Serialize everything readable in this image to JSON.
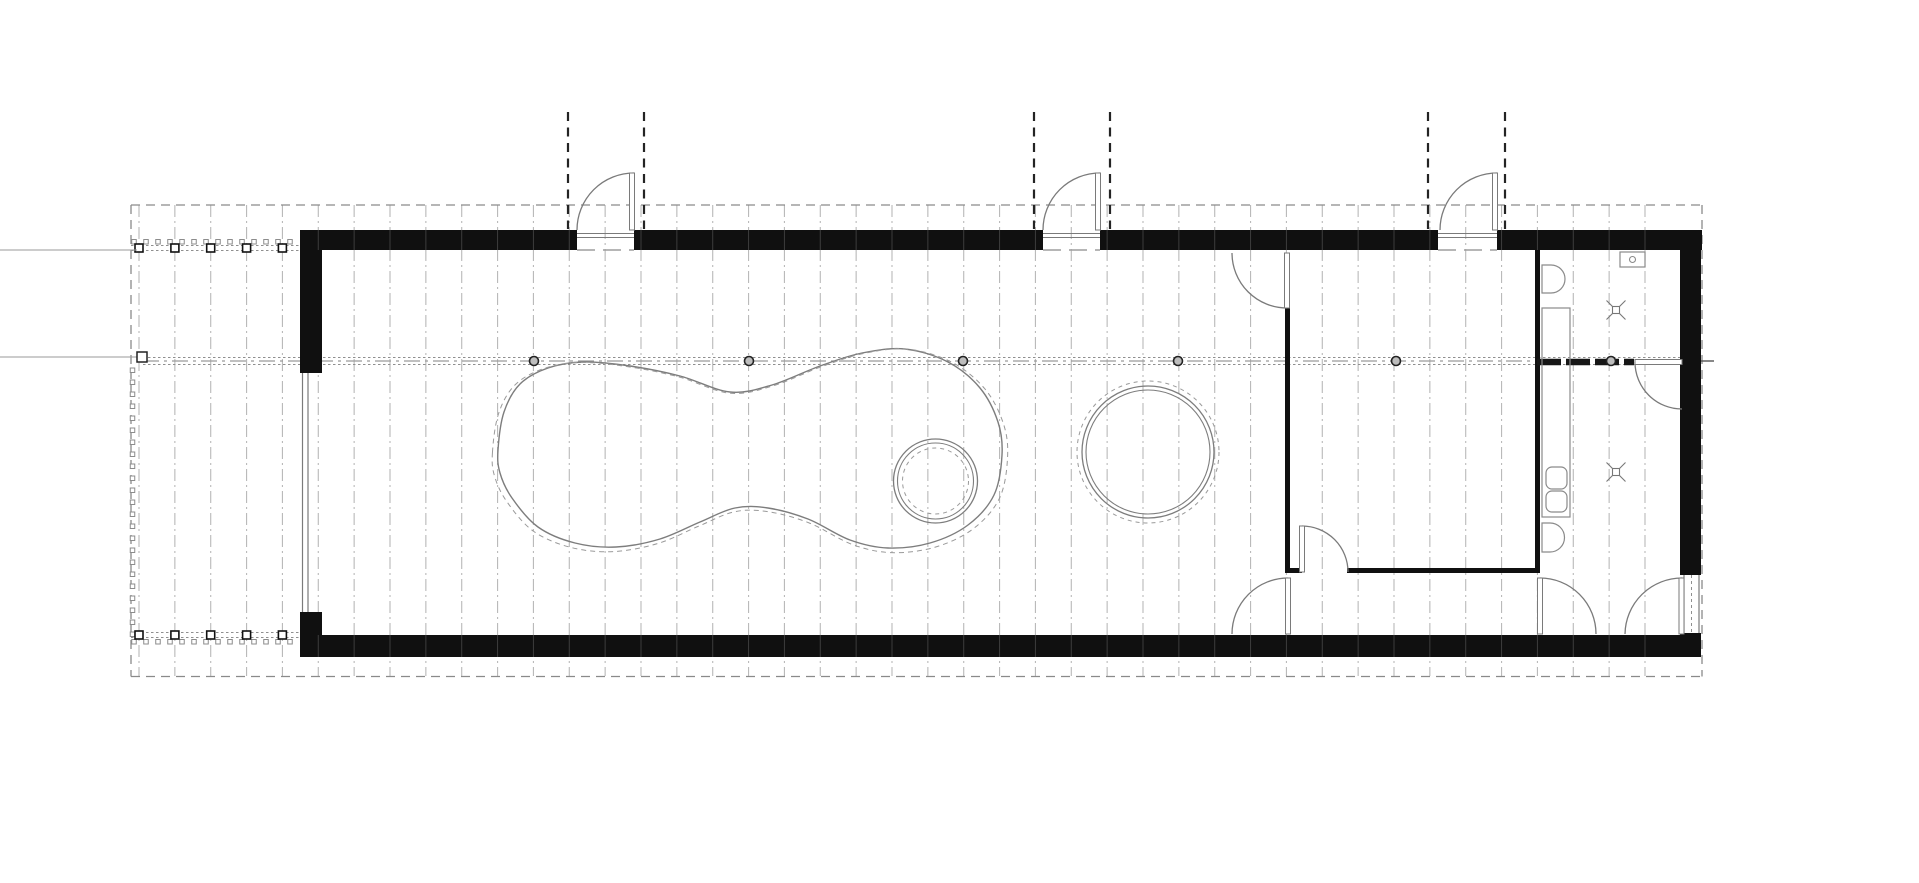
{
  "drawing": {
    "title": "single-storey pavilion floor plan",
    "canvas": {
      "w": 1919,
      "h": 883,
      "bg": "#ffffff"
    },
    "colors": {
      "wall": "#101010",
      "grid": "#b9b9b9",
      "wall_tick": "#3d3d3d",
      "boundary": "#8a8a8a",
      "thin": "#7a7a7a",
      "fixture": "#8a8a8a",
      "pool": "#7d7d7d",
      "pool_dash": "#9a9a9a",
      "dotted": "#8f8f8f",
      "dashdot": "#9a9a9a",
      "ridge_black": "#161616",
      "projection": "#242424",
      "node_fill": "#bdbdbd",
      "node_stroke": "#222222",
      "ref": "#9a9a9a"
    },
    "grid": {
      "x_start": 139,
      "step": 35.857,
      "count": 43,
      "y1": 205,
      "y2": 676,
      "dash": "12 4 2 4"
    },
    "boundary": {
      "x1": 131,
      "y1": 205,
      "x2": 1702,
      "y2": 676.5,
      "dash": "9 6"
    },
    "walls": [
      [
        300,
        230,
        277,
        20
      ],
      [
        634,
        230,
        409,
        20
      ],
      [
        1100,
        230,
        338,
        20
      ],
      [
        1497,
        230,
        205,
        20
      ],
      [
        300,
        635,
        1401,
        22
      ],
      [
        300,
        230,
        22,
        143
      ],
      [
        300,
        612,
        22,
        45
      ],
      [
        1680,
        250,
        21,
        325
      ],
      [
        1680,
        633,
        21,
        24
      ],
      [
        1285,
        308,
        5,
        263
      ],
      [
        1535,
        250,
        5,
        323
      ],
      [
        1285,
        568,
        17,
        5
      ],
      [
        1347,
        568,
        193,
        5
      ]
    ],
    "top_openings": [
      [
        577,
        634
      ],
      [
        1043,
        1100
      ],
      [
        1438,
        1497
      ]
    ],
    "wall_ticks": {
      "top": [
        230,
        250
      ],
      "bottom": [
        635,
        657
      ],
      "x_min": 300,
      "x_max": 1701
    },
    "projection_lines": {
      "y1": 112,
      "y2": 229,
      "dash": "9 6.5",
      "xs": [
        568,
        644,
        1034,
        1110,
        1428,
        1505
      ]
    },
    "thresholds": [
      {
        "x1": 577,
        "x2": 634
      },
      {
        "x1": 1043,
        "x2": 1100
      },
      {
        "x1": 1438,
        "x2": 1497
      }
    ],
    "door_arcs": [
      {
        "name": "entry-door-1",
        "d": "M577,230 A57,57 0 0 1 634,173"
      },
      {
        "name": "entry-door-2",
        "d": "M1043,230 A57,57 0 0 1 1100,173"
      },
      {
        "name": "entry-door-3",
        "d": "M1440,230 A57,57 0 0 1 1497,173"
      },
      {
        "name": "room-door-top",
        "d": "M1232,253 A55,55 0 0 0 1287,308"
      },
      {
        "name": "room-door-bottom",
        "d": "M1302,526 A46,46 0 0 1 1348,572"
      },
      {
        "name": "passage-door-left",
        "d": "M1232,634 A56,56 0 0 1 1288,578"
      },
      {
        "name": "passage-door-right",
        "d": "M1540,578 A56,56 0 0 1 1596,634"
      },
      {
        "name": "bath-door",
        "d": "M1625,634 A57,57 0 0 1 1682,578"
      },
      {
        "name": "wet-partition-door",
        "d": "M1635,362 A47,47 0 0 0 1682,409"
      }
    ],
    "door_leaves": [
      [
        629.5,
        173,
        5,
        57
      ],
      [
        1095.5,
        173,
        5,
        57
      ],
      [
        1492.5,
        173,
        5,
        57
      ],
      [
        1284.5,
        253,
        5,
        55
      ],
      [
        1299.5,
        526,
        5,
        46
      ],
      [
        1285.5,
        578,
        5,
        56
      ],
      [
        1537.5,
        578,
        5,
        56
      ],
      [
        1679,
        578,
        5,
        56
      ],
      [
        1635,
        359.5,
        47,
        5
      ]
    ],
    "windows": {
      "left": {
        "lines": [
          [
            302.5,
            373,
            302.5,
            612
          ],
          [
            308,
            373,
            308,
            612
          ]
        ]
      },
      "right": {
        "lines": [
          [
            1684,
            575,
            1684,
            633
          ],
          [
            1699,
            575,
            1699,
            633
          ]
        ],
        "dotted": [
          1691.5,
          575,
          1691.5,
          633
        ]
      }
    },
    "ridge": {
      "dotted_pair": [
        [
          143,
          357.5,
          1682,
          357.5
        ],
        [
          143,
          364.5,
          1682,
          364.5
        ]
      ],
      "dashdot": [
        143,
        361,
        1537,
        361
      ],
      "black_segment": [
        1537,
        362,
        1634,
        362
      ],
      "tick_right": [
        1701,
        361,
        1714,
        361
      ],
      "nodes_y": 361,
      "nodes_x": [
        534,
        749,
        963,
        1178,
        1396,
        1611
      ],
      "node_r": 4.5
    },
    "ref_lines": {
      "lines": [
        [
          0,
          250,
          137,
          250
        ],
        [
          0,
          357,
          137,
          357
        ]
      ],
      "marker_square": [
        137,
        352,
        10,
        10
      ]
    },
    "porch": {
      "dotted_rows": [
        [
          131,
          245.5,
          300,
          245.5
        ],
        [
          131,
          250.5,
          300,
          250.5
        ],
        [
          131,
          632.5,
          300,
          632.5
        ],
        [
          131,
          637.5,
          300,
          637.5
        ]
      ],
      "posts_x": [
        139,
        174.9,
        210.7,
        246.6,
        282.4
      ],
      "posts_y": [
        248,
        635
      ],
      "post_size": 8,
      "strips": [
        {
          "x": 134,
          "y": 239.5,
          "dx": 12,
          "dy": 0,
          "count": 14,
          "w": 4.5,
          "h": 4.5
        },
        {
          "x": 134,
          "y": 639.5,
          "dx": 12,
          "dy": 0,
          "count": 14,
          "w": 4.5,
          "h": 4.5
        },
        {
          "x": 132.5,
          "y": 368,
          "dx": 0,
          "dy": 12,
          "count": 23,
          "w": 4.5,
          "h": 4.5
        }
      ]
    },
    "pool": {
      "solid_points": [
        [
          498,
          450
        ],
        [
          504,
          412
        ],
        [
          520,
          384
        ],
        [
          548,
          368
        ],
        [
          584,
          362
        ],
        [
          630,
          366
        ],
        [
          680,
          376
        ],
        [
          730,
          392
        ],
        [
          772,
          385
        ],
        [
          820,
          366
        ],
        [
          862,
          353
        ],
        [
          905,
          349
        ],
        [
          948,
          362
        ],
        [
          980,
          388
        ],
        [
          998,
          422
        ],
        [
          1002,
          455
        ],
        [
          994,
          495
        ],
        [
          968,
          525
        ],
        [
          930,
          543
        ],
        [
          888,
          548
        ],
        [
          850,
          540
        ],
        [
          808,
          519
        ],
        [
          768,
          508
        ],
        [
          735,
          508
        ],
        [
          700,
          522
        ],
        [
          660,
          539
        ],
        [
          616,
          547
        ],
        [
          575,
          543
        ],
        [
          538,
          527
        ],
        [
          512,
          498
        ],
        [
          500,
          473
        ]
      ],
      "dashed_scale": 1.022,
      "dashed_center": [
        750,
        452
      ],
      "dashed_shift_y": 2.5,
      "dash": "5 4"
    },
    "island": {
      "cx": 935.5,
      "cy": 481,
      "r_outer": 42,
      "r_inner": 38,
      "r_dashed": 33,
      "dash": "4 4"
    },
    "round_feature": {
      "cx": 1148,
      "cy": 452,
      "r_outer": 66,
      "r_inner": 62,
      "r_dashed": 71,
      "dash": "4 4"
    },
    "fixtures": {
      "toilet_top_path": "M1542,265 h9 a14,14 0 0 1 0,28 h-9 z",
      "toilet_bottom_path": "M1542,523 h8 a14.5,14.5 0 0 1 0,29 h-8 z",
      "counter_rect": [
        1542,
        308,
        28,
        209
      ],
      "sinks": [
        [
          1546,
          467,
          21,
          22
        ],
        [
          1546,
          491,
          21,
          21
        ]
      ],
      "cistern_rect": [
        1620,
        252,
        25,
        15
      ],
      "cistern_circle": [
        1632.5,
        259.5,
        3
      ],
      "drains": [
        [
          1616,
          310
        ],
        [
          1616,
          472
        ]
      ]
    }
  }
}
